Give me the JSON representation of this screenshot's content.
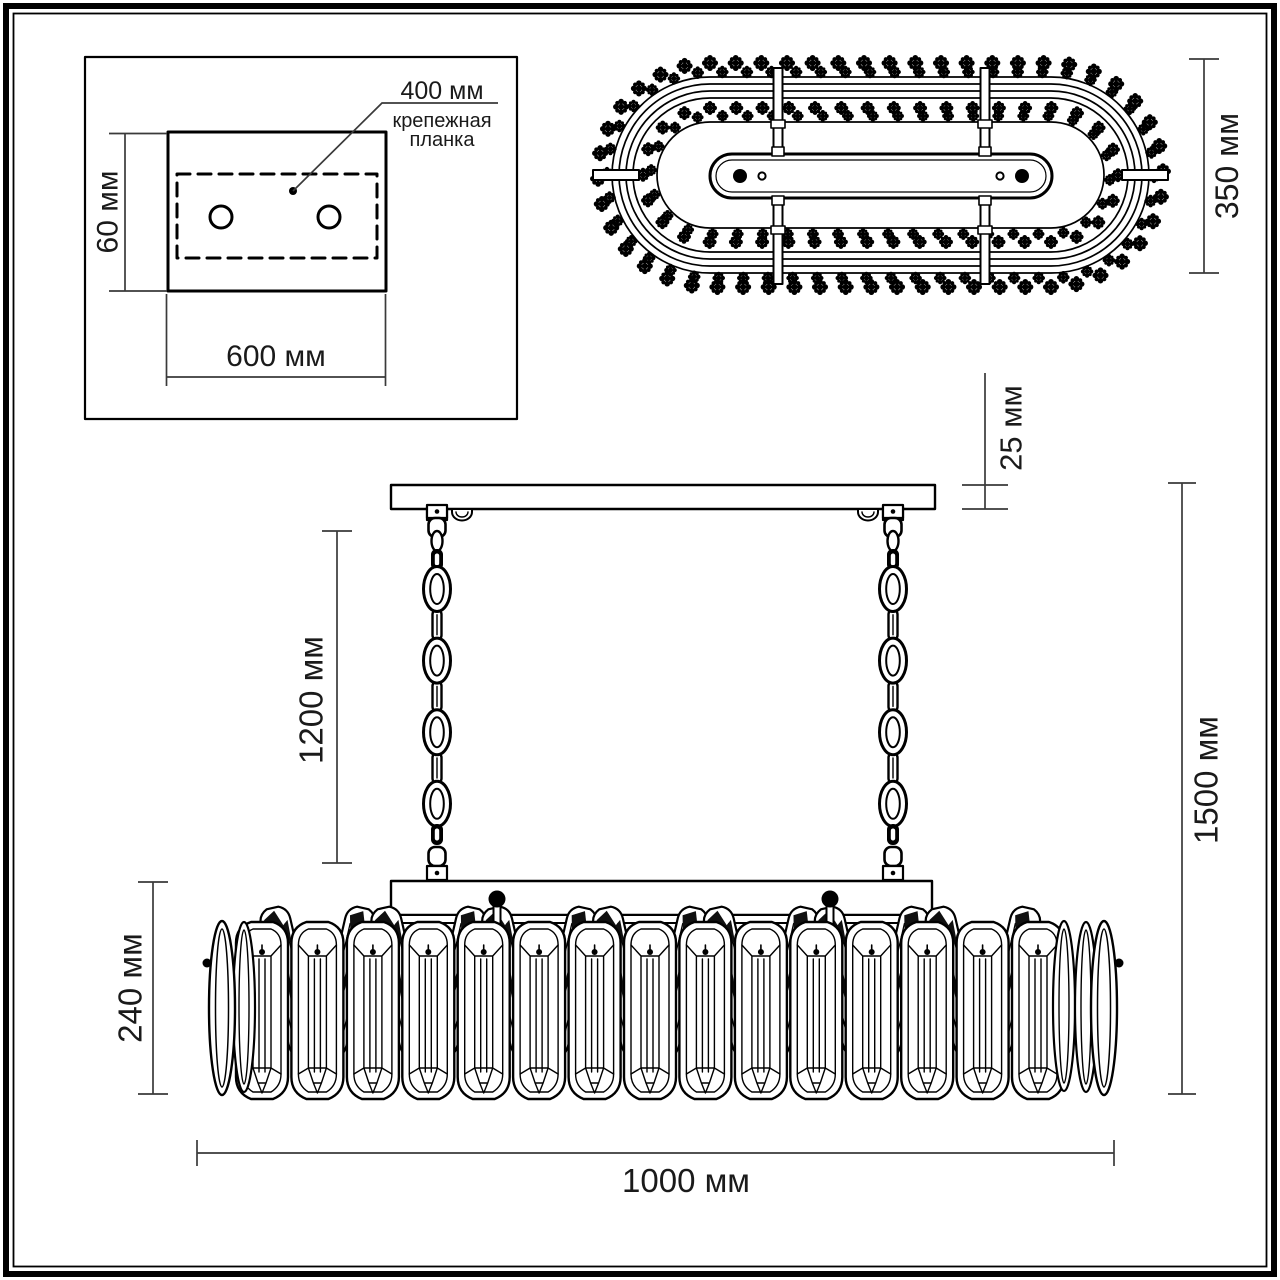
{
  "detail_panel": {
    "bracket_distance_label": "400 мм",
    "bracket_caption_line1": "крепежная",
    "bracket_caption_line2": "планка",
    "plate_height_label": "60 мм",
    "plate_width_label": "600 мм"
  },
  "top_view": {
    "depth_label": "350 мм"
  },
  "side_view": {
    "canopy_thickness_label": "25 мм",
    "chain_length_label": "1200 мм",
    "total_height_label": "1500 мм",
    "body_height_label": "240 мм",
    "body_width_label": "1000 мм"
  },
  "colors": {
    "line": "#000000",
    "dim_line": "#3a3a3a",
    "text": "#1a1a1a",
    "background": "#ffffff"
  }
}
